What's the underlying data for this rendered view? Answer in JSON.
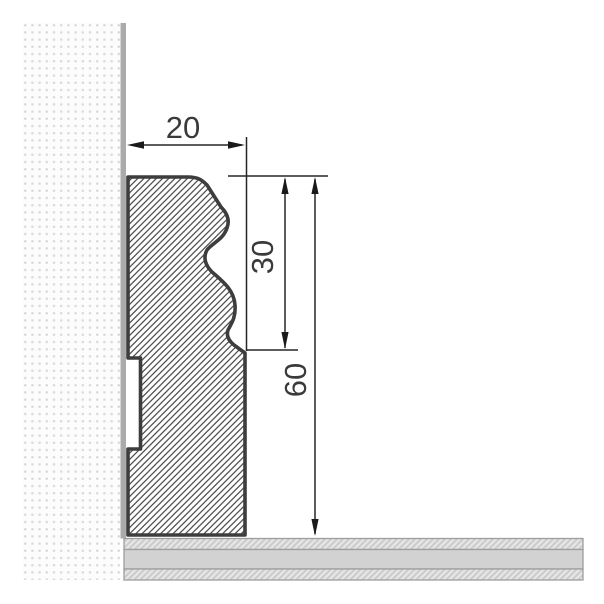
{
  "page": {
    "background": "#ffffff",
    "description": "Technical cross-section drawing of a skirting board profile mounted against a wall above a layered floor, with three dimension annotations"
  },
  "drawing": {
    "wall": {
      "texture": "dotted-stipple",
      "dot_color": "#d8d8d8",
      "background": "#fcfcfc",
      "surface_line_color": "#ababab"
    },
    "skirting": {
      "outline_color": "#3d3d3d",
      "hatch": "diagonal-45",
      "hatch_color": "#3c3c3c",
      "has_rear_groove": true
    },
    "floor": {
      "layer_count": 3,
      "plain_fill": "#d2d2d2",
      "hatch_fill": "#e4e4e4",
      "hatch_line_color": "#c8c8c8",
      "border_color": "#9e9e9e"
    },
    "dimension_color": "#262626",
    "text_color": "#3a3a3a",
    "dimensions": [
      {
        "id": "width",
        "label": "20",
        "value": 20,
        "orientation": "horizontal"
      },
      {
        "id": "molded-height",
        "label": "30",
        "value": 30,
        "orientation": "vertical"
      },
      {
        "id": "total-height",
        "label": "60",
        "value": 60,
        "orientation": "vertical"
      }
    ]
  }
}
